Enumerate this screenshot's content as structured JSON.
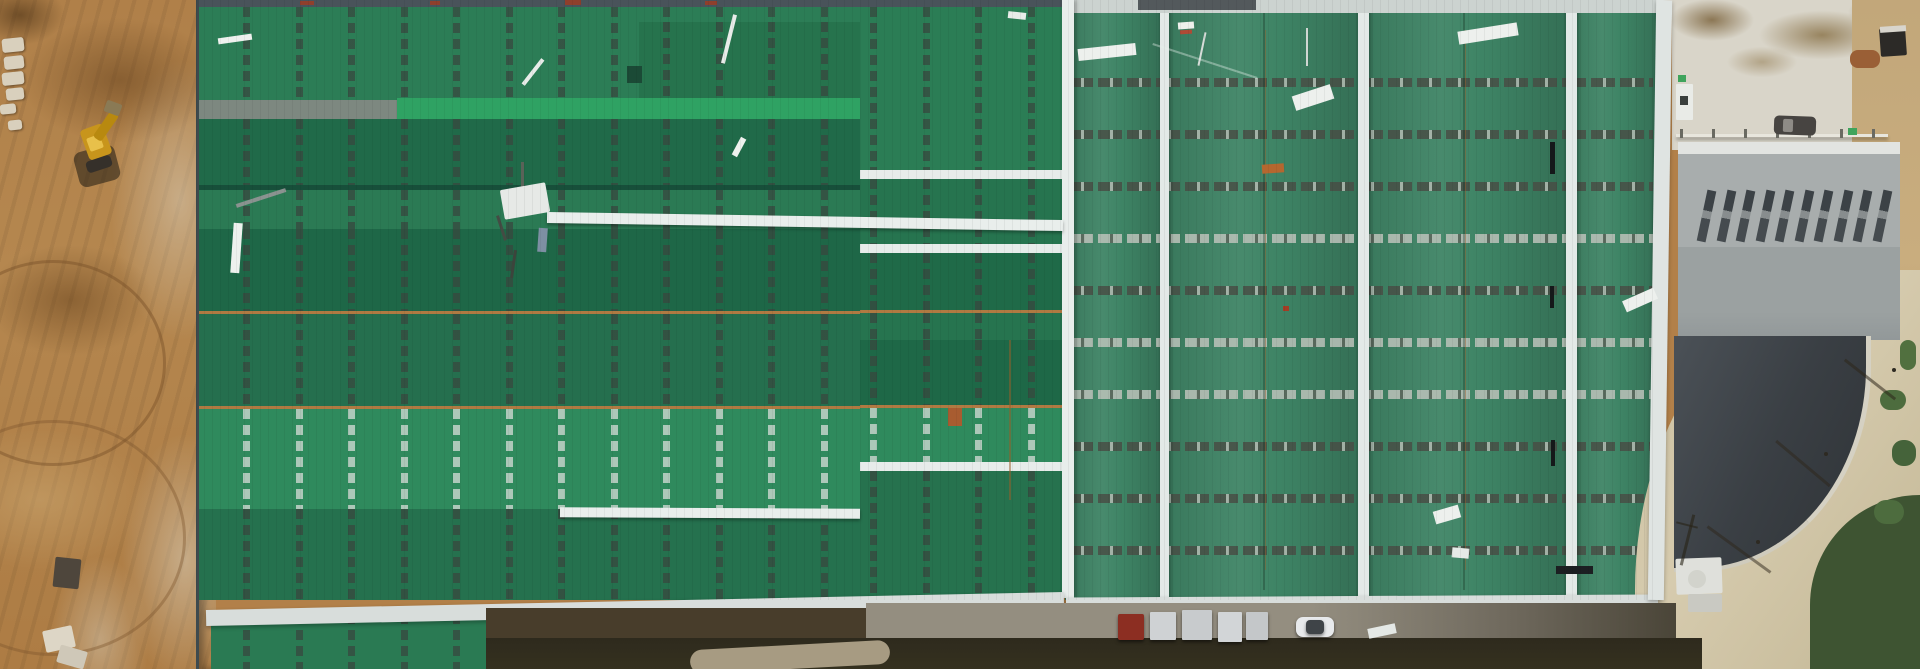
{
  "meta": {
    "title": "Aerial drone view of industrial warehouse construction site with green metal roofs, dirt earthworks, excavator, access road and parked vehicles",
    "width": 1920,
    "height": 669
  },
  "palette": {
    "green_dark": "#1e6747",
    "green_mid": "#2b7a54",
    "green_light": "#2f8a5d",
    "green_bright": "#2fa263",
    "green_textured": "#3e8465",
    "white_trim": "#e9eeec",
    "orange_ridge": "#b07a42",
    "dirt": "#b28049",
    "dirt_dark": "#8f6430",
    "dirt_light": "#cfa96f",
    "rubble": "#d8cdb9",
    "concrete": "#d9d5c9",
    "gray_roof": "#a8adad",
    "charcoal_roof": "#3a3f44",
    "road_tan": "#cfc3a3",
    "road_gray": "#8a8578",
    "vegetation": "#47603a",
    "excavator_yellow": "#d8a018"
  },
  "left_building": {
    "x": 196,
    "w": 664,
    "h": 669,
    "dash": {
      "spacing": 52.5,
      "offset": 44,
      "width": 7,
      "seg": 10,
      "gap": 6,
      "dark": "rgba(56,70,62,0.72)",
      "light": "rgba(208,218,211,0.78)"
    },
    "bands": [
      {
        "name": "roof-top-edge",
        "y": 0,
        "h": 7,
        "color": "#49535a"
      },
      {
        "name": "band-1",
        "y": 7,
        "h": 93,
        "color": "#2c7d56",
        "dash": "dark"
      },
      {
        "name": "band-1-inset",
        "y": 22,
        "h": 78,
        "x": 440,
        "w": 224,
        "color": "#26734d",
        "dash": "dark"
      },
      {
        "name": "ridge-cap-gray",
        "y": 100,
        "h": 20,
        "x": 0,
        "w": 198,
        "color": "#7d8880"
      },
      {
        "name": "bright-green-strip",
        "y": 98,
        "h": 21,
        "x": 198,
        "w": 466,
        "color": "#2fa263",
        "rib": true
      },
      {
        "name": "band-2",
        "y": 119,
        "h": 66,
        "color": "#206a49",
        "dash": "dark",
        "tex": true
      },
      {
        "name": "ridge-shadow-line",
        "y": 185,
        "h": 5,
        "color": "#174f3a"
      },
      {
        "name": "band-3",
        "y": 190,
        "h": 39,
        "color": "#2b7a54",
        "dash": "dark"
      },
      {
        "name": "band-4",
        "y": 229,
        "h": 82,
        "color": "#1e6747",
        "dash": "dark"
      },
      {
        "name": "orange-ridge-1",
        "y": 311,
        "h": 3,
        "color": "#b07a42"
      },
      {
        "name": "band-5",
        "y": 314,
        "h": 92,
        "color": "#256f4e",
        "dash": "dark",
        "tex": true
      },
      {
        "name": "orange-ridge-2",
        "y": 406,
        "h": 3,
        "color": "#b07a42"
      },
      {
        "name": "band-6",
        "y": 409,
        "h": 100,
        "color": "#2f8a5d",
        "dash": "light",
        "tex": true
      },
      {
        "name": "band-7",
        "y": 509,
        "h": 91,
        "color": "#25714e",
        "dash": "dark",
        "tex": true
      },
      {
        "name": "annex-roof",
        "y": 614,
        "h": 55,
        "x": 12,
        "w": 290,
        "color": "#2a7a53",
        "dash": "dark"
      }
    ]
  },
  "mid_section": {
    "x": 860,
    "w": 203,
    "h": 600,
    "dash": {
      "spacing": 52.5,
      "offset": 10,
      "width": 7,
      "dark": "rgba(56,70,62,0.72)",
      "light": "rgba(208,218,211,0.78)"
    },
    "bands": [
      {
        "name": "mid-top-edge",
        "y": 0,
        "h": 7,
        "color": "#49535a"
      },
      {
        "name": "mid-band-1",
        "y": 7,
        "h": 163,
        "color": "#2b7d55",
        "dash": "dark",
        "tex": true
      },
      {
        "name": "mid-divider",
        "y": 170,
        "h": 9,
        "color": "#e7ecea"
      },
      {
        "name": "mid-band-2",
        "y": 179,
        "h": 65,
        "color": "#26744f",
        "dash": "dark",
        "tex": true
      },
      {
        "name": "mid-divider",
        "y": 244,
        "h": 9,
        "color": "#e7ecea"
      },
      {
        "name": "mid-band-3",
        "y": 253,
        "h": 57,
        "color": "#1f6a48",
        "dash": "dark"
      },
      {
        "name": "mid-orange-1",
        "y": 310,
        "h": 3,
        "color": "#b07a42"
      },
      {
        "name": "mid-band-4",
        "y": 313,
        "h": 27,
        "color": "#26744f",
        "dash": "dark"
      },
      {
        "name": "mid-band-4b",
        "y": 340,
        "h": 65,
        "color": "#1e6847",
        "dash": "dark",
        "tex": true
      },
      {
        "name": "mid-orange-2",
        "y": 405,
        "h": 3,
        "color": "#b07a42"
      },
      {
        "name": "mid-band-5",
        "y": 408,
        "h": 54,
        "color": "#2f8a5d",
        "dash": "light",
        "tex": true
      },
      {
        "name": "mid-divider",
        "y": 462,
        "h": 9,
        "color": "#e7ecea"
      },
      {
        "name": "mid-band-6",
        "y": 471,
        "h": 129,
        "color": "#26724e",
        "dash": "dark",
        "tex": true
      }
    ]
  },
  "right_building": {
    "x": 1065,
    "w": 592,
    "h": 600,
    "base": "#3e8465",
    "top_strip": {
      "h": 13,
      "color": "#ccd3d0"
    },
    "rows": {
      "start": 78,
      "spacing": 52,
      "h": 9,
      "styles": [
        "dark",
        "dark",
        "dark",
        "silver",
        "dark",
        "silver",
        "silver",
        "dark",
        "dark",
        "dark"
      ],
      "dark": "repeating-linear-gradient(90deg, rgba(72,76,68,0.82) 0 12px, rgba(180,186,178,0.85) 12px 15px, rgba(72,76,68,0.82) 15px 24px, rgba(0,0,0,0) 24px 29px)",
      "silver": "repeating-linear-gradient(90deg, rgba(188,194,186,0.85) 0 12px, rgba(96,100,92,0.8) 12px 15px, rgba(188,194,186,0.85) 15px 24px, rgba(0,0,0,0) 24px 29px)"
    },
    "panels": [
      [
        0,
        95
      ],
      [
        95,
        293
      ],
      [
        293,
        501
      ],
      [
        501,
        592
      ]
    ],
    "inner_ridges": [
      {
        "x": 95,
        "w": 9
      },
      {
        "x": 293,
        "w": 11
      },
      {
        "x": 501,
        "w": 11
      }
    ],
    "valleys": [
      {
        "x": 198
      },
      {
        "x": 398
      }
    ]
  },
  "scene_ridges": [
    {
      "name": "roof-ridge-strip",
      "x": 1062,
      "y": 0,
      "w": 12,
      "h": 598,
      "color": "#e8edeb"
    }
  ],
  "stripes": [
    {
      "name": "white-walkway-stripe",
      "x": 547,
      "y": 216,
      "w": 516,
      "h": 11,
      "rot": 0.9,
      "color": "#e9eeec"
    },
    {
      "name": "white-walkway-stripe",
      "x": 560,
      "y": 508,
      "w": 300,
      "h": 10,
      "rot": 0.3,
      "color": "#e9eeec"
    }
  ],
  "eaves": [
    {
      "name": "eave-strip-left",
      "x": 206,
      "y": 601,
      "w": 858,
      "h": 16,
      "rot": -1.2,
      "color": "#d8dddb"
    },
    {
      "name": "eave-strip-right",
      "x": 1066,
      "y": 596,
      "w": 592,
      "h": 13,
      "rot": -0.3,
      "color": "#d8dddb"
    },
    {
      "name": "eave-strip-east",
      "x": 1652,
      "y": 0,
      "w": 16,
      "h": 600,
      "rot": 0.8,
      "color": "#dfe4e2"
    }
  ],
  "bottom": {
    "vehicles": [
      {
        "name": "red-box-truck",
        "x": 1118,
        "y": 614,
        "w": 26,
        "h": 26,
        "color": "#8c2e22",
        "r": 2
      },
      {
        "name": "material-stack",
        "x": 1150,
        "y": 612,
        "w": 26,
        "h": 28,
        "color": "#cfd2d4",
        "r": 1
      },
      {
        "name": "material-stack",
        "x": 1182,
        "y": 610,
        "w": 30,
        "h": 30,
        "color": "#c8cbcd",
        "r": 1
      },
      {
        "name": "material-stack",
        "x": 1218,
        "y": 612,
        "w": 24,
        "h": 30,
        "color": "#d2d5d7",
        "r": 1
      },
      {
        "name": "material-stack",
        "x": 1246,
        "y": 612,
        "w": 22,
        "h": 28,
        "color": "#c4c7c9",
        "r": 1
      },
      {
        "name": "white-car",
        "x": 1296,
        "y": 617,
        "w": 38,
        "h": 20,
        "color": "#e8eaec",
        "r": 7
      },
      {
        "name": "white-car-roof",
        "x": 1306,
        "y": 620,
        "w": 18,
        "h": 14,
        "color": "#3f4448",
        "r": 4
      }
    ]
  },
  "far_right": {
    "windows": {
      "count": 10,
      "x0": 1702,
      "step": 19.5,
      "y": 190,
      "w": 9,
      "h": 52,
      "rot": 12,
      "bg": "linear-gradient(180deg,#3c4246 0 40%, rgba(60,66,70,0.3) 40% 55%, #454b4f 55%)"
    },
    "fence_posts": {
      "count": 7,
      "x0": 1680,
      "step": 32,
      "y": 129,
      "w": 3,
      "h": 9,
      "color": "#6a6a62"
    }
  },
  "objects": [
    {
      "name": "red-edge-mark",
      "x": 300,
      "y": 1,
      "w": 14,
      "h": 4,
      "color": "#8f3f2c"
    },
    {
      "name": "red-edge-mark",
      "x": 430,
      "y": 1,
      "w": 10,
      "h": 4,
      "color": "#8f3f2c"
    },
    {
      "name": "red-edge-mark",
      "x": 565,
      "y": 0,
      "w": 16,
      "h": 5,
      "color": "#8f3f2c"
    },
    {
      "name": "red-edge-mark",
      "x": 705,
      "y": 1,
      "w": 12,
      "h": 4,
      "color": "#8f3f2c"
    },
    {
      "name": "roof-frame-piece",
      "x": 1138,
      "y": 0,
      "w": 118,
      "h": 10,
      "color": "#53595c"
    },
    {
      "name": "white-plank",
      "x": 218,
      "y": 36,
      "w": 34,
      "h": 6,
      "color": "#eef1ee",
      "rot": -8
    },
    {
      "name": "white-plank",
      "x": 727,
      "y": 14,
      "w": 4,
      "h": 50,
      "color": "#e8ece9",
      "rot": 14
    },
    {
      "name": "white-plank",
      "x": 531,
      "y": 56,
      "w": 4,
      "h": 32,
      "color": "#e8ece9",
      "rot": 38
    },
    {
      "name": "white-plank",
      "x": 232,
      "y": 223,
      "w": 9,
      "h": 50,
      "color": "#eef1ee",
      "rot": 4
    },
    {
      "name": "white-plank",
      "x": 736,
      "y": 137,
      "w": 6,
      "h": 20,
      "color": "#eef1ee",
      "rot": 28
    },
    {
      "name": "debris-stick",
      "x": 235,
      "y": 196,
      "w": 52,
      "h": 4,
      "color": "#8a9390",
      "rot": -18
    },
    {
      "name": "dark-panel-patch",
      "x": 627,
      "y": 66,
      "w": 15,
      "h": 17,
      "color": "#1b4a36"
    },
    {
      "name": "white-plank",
      "x": 1078,
      "y": 46,
      "w": 58,
      "h": 12,
      "color": "#edf0ed",
      "rot": -6
    },
    {
      "name": "white-plank",
      "x": 1293,
      "y": 90,
      "w": 40,
      "h": 15,
      "color": "#edf0ed",
      "rot": -18
    },
    {
      "name": "white-plank",
      "x": 1458,
      "y": 27,
      "w": 60,
      "h": 13,
      "color": "#edf0ed",
      "rot": -9
    },
    {
      "name": "white-plank",
      "x": 1623,
      "y": 294,
      "w": 34,
      "h": 12,
      "color": "#edf0ed",
      "rot": -24
    },
    {
      "name": "white-plank",
      "x": 1368,
      "y": 626,
      "w": 28,
      "h": 10,
      "color": "#e4e8e5",
      "rot": -12
    },
    {
      "name": "white-plank",
      "x": 1008,
      "y": 12,
      "w": 18,
      "h": 7,
      "color": "#e8ece9",
      "rot": 6
    },
    {
      "name": "white-plank",
      "x": 1434,
      "y": 508,
      "w": 26,
      "h": 13,
      "color": "#edf0ed",
      "rot": -16
    },
    {
      "name": "white-plank",
      "x": 1452,
      "y": 548,
      "w": 17,
      "h": 10,
      "color": "#e6eae7",
      "rot": 5
    },
    {
      "name": "white-label-tag",
      "x": 1178,
      "y": 22,
      "w": 16,
      "h": 7,
      "color": "#eef0ec",
      "rot": -4
    },
    {
      "name": "red-label-mark",
      "x": 1180,
      "y": 30,
      "w": 12,
      "h": 4,
      "color": "#b04a35",
      "rot": -4
    },
    {
      "name": "thin-pole",
      "x": 1306,
      "y": 28,
      "w": 2,
      "h": 38,
      "color": "#cfd6d2"
    },
    {
      "name": "thin-pole",
      "x": 1201,
      "y": 32,
      "w": 2,
      "h": 34,
      "color": "#d6dcd8",
      "rot": 12
    },
    {
      "name": "scratch-line",
      "x": 1150,
      "y": 60,
      "w": 110,
      "h": 2,
      "color": "rgba(230,240,235,0.4)",
      "rot": 18
    },
    {
      "name": "equipment-mast",
      "x": 521,
      "y": 162,
      "w": 3,
      "h": 30,
      "color": "#5a6258"
    },
    {
      "name": "equipment-box",
      "x": 502,
      "y": 186,
      "w": 46,
      "h": 30,
      "color": "#e6e9e6",
      "rot": -10,
      "r": 2
    },
    {
      "name": "equipment-leg",
      "x": 500,
      "y": 215,
      "w": 3,
      "h": 26,
      "color": "#444c44",
      "rot": -18
    },
    {
      "name": "equipment-leg",
      "x": 512,
      "y": 250,
      "w": 3,
      "h": 28,
      "color": "#3c443c",
      "rot": 8
    },
    {
      "name": "equipment-tag",
      "x": 538,
      "y": 228,
      "w": 9,
      "h": 24,
      "color": "#7d8fa3",
      "rot": 4
    },
    {
      "name": "rust-patch",
      "x": 948,
      "y": 408,
      "w": 14,
      "h": 18,
      "color": "#a85c30"
    },
    {
      "name": "rust-patch",
      "x": 1262,
      "y": 164,
      "w": 22,
      "h": 9,
      "color": "#b5672f",
      "rot": -4
    },
    {
      "name": "rust-dot",
      "x": 1283,
      "y": 306,
      "w": 6,
      "h": 5,
      "color": "#a33d25"
    },
    {
      "name": "roof-gap-mark",
      "x": 1550,
      "y": 142,
      "w": 5,
      "h": 32,
      "color": "#15181a"
    },
    {
      "name": "roof-gap-mark",
      "x": 1550,
      "y": 286,
      "w": 4,
      "h": 22,
      "color": "#15181a"
    },
    {
      "name": "roof-gap-mark",
      "x": 1551,
      "y": 440,
      "w": 4,
      "h": 26,
      "color": "#15181a"
    },
    {
      "name": "roof-corner-shadow",
      "x": 1556,
      "y": 566,
      "w": 37,
      "h": 8,
      "color": "#1c1f22"
    },
    {
      "name": "excavator-shadow",
      "x": 76,
      "y": 148,
      "w": 42,
      "h": 36,
      "color": "rgba(30,25,18,0.55)",
      "r": 8,
      "rot": -15
    },
    {
      "name": "excavator-body",
      "x": 84,
      "y": 126,
      "w": 24,
      "h": 32,
      "color": "#c8951c",
      "rot": -20,
      "r": 4
    },
    {
      "name": "excavator-cab",
      "x": 88,
      "y": 136,
      "w": 14,
      "h": 14,
      "color": "#e8c04a",
      "rot": -20,
      "r": 2
    },
    {
      "name": "excavator-arm",
      "x": 101,
      "y": 110,
      "w": 10,
      "h": 32,
      "color": "#b8890f",
      "rot": 35,
      "r": 3
    },
    {
      "name": "excavator-bucket",
      "x": 105,
      "y": 102,
      "w": 16,
      "h": 12,
      "color": "#8a7a55",
      "rot": 20,
      "r": 2
    },
    {
      "name": "excavator-wheels",
      "x": 86,
      "y": 158,
      "w": 26,
      "h": 12,
      "color": "#35302a",
      "rot": -18,
      "r": 4
    },
    {
      "name": "debris-white-block",
      "x": 44,
      "y": 628,
      "w": 30,
      "h": 22,
      "color": "#ddd6c6",
      "rot": -12,
      "r": 2
    },
    {
      "name": "debris-white-block",
      "x": 58,
      "y": 648,
      "w": 28,
      "h": 18,
      "color": "#cfc8b8",
      "rot": 16,
      "r": 2
    },
    {
      "name": "debris-dark-block",
      "x": 54,
      "y": 558,
      "w": 26,
      "h": 30,
      "color": "#4e463c",
      "rot": 6,
      "r": 2
    },
    {
      "name": "ground-road-curve",
      "x": 690,
      "y": 645,
      "w": 200,
      "h": 24,
      "color": "#a79b82",
      "rot": -3,
      "r": 12
    },
    {
      "name": "suv-car",
      "x": 1774,
      "y": 116,
      "w": 42,
      "h": 19,
      "color": "#474441",
      "rot": 2,
      "r": 5
    },
    {
      "name": "suv-windshield",
      "x": 1783,
      "y": 119,
      "w": 10,
      "h": 13,
      "color": "#8e8b86",
      "rot": 2,
      "r": 2
    },
    {
      "name": "trailer-dark",
      "x": 1880,
      "y": 28,
      "w": 26,
      "h": 28,
      "color": "#2c2a27",
      "rot": -4,
      "r": 2
    },
    {
      "name": "trailer-top",
      "x": 1880,
      "y": 26,
      "w": 26,
      "h": 6,
      "color": "#d8d5cd",
      "rot": -4
    },
    {
      "name": "mulch-pile",
      "x": 1850,
      "y": 50,
      "w": 30,
      "h": 18,
      "color": "#9a5f36",
      "r": 8
    },
    {
      "name": "pad-structure",
      "x": 1676,
      "y": 84,
      "w": 17,
      "h": 36,
      "color": "#e9ebe7",
      "r": 1
    },
    {
      "name": "pad-structure-door",
      "x": 1680,
      "y": 96,
      "w": 8,
      "h": 9,
      "color": "#3a3f3d"
    },
    {
      "name": "pad-green-marker",
      "x": 1678,
      "y": 75,
      "w": 8,
      "h": 7,
      "color": "#3fa45c"
    },
    {
      "name": "pad-green-marker",
      "x": 1848,
      "y": 128,
      "w": 9,
      "h": 7,
      "color": "#3fa45c"
    },
    {
      "name": "rooftop-tank",
      "x": 1688,
      "y": 570,
      "w": 18,
      "h": 18,
      "color": "#d2d3cc",
      "r": 9
    },
    {
      "name": "loading-dock",
      "x": 1688,
      "y": 594,
      "w": 34,
      "h": 18,
      "color": "#c9c9c2",
      "r": 2
    },
    {
      "name": "bush",
      "x": 1880,
      "y": 390,
      "w": 26,
      "h": 20,
      "color": "#4d6c3e",
      "r": 10
    },
    {
      "name": "bush",
      "x": 1892,
      "y": 440,
      "w": 24,
      "h": 26,
      "color": "#45633a",
      "r": 11
    },
    {
      "name": "bush",
      "x": 1874,
      "y": 500,
      "w": 30,
      "h": 24,
      "color": "#4d6c3e",
      "r": 12
    },
    {
      "name": "bush",
      "x": 1900,
      "y": 340,
      "w": 16,
      "h": 30,
      "color": "#51703f",
      "r": 8
    },
    {
      "name": "pole-shadow",
      "x": 1838,
      "y": 378,
      "w": 64,
      "h": 3,
      "color": "rgba(45,38,25,0.55)",
      "rot": 38
    },
    {
      "name": "pole-shadow",
      "x": 1768,
      "y": 462,
      "w": 70,
      "h": 3,
      "color": "rgba(45,38,25,0.5)",
      "rot": 40
    },
    {
      "name": "pole-shadow",
      "x": 1700,
      "y": 548,
      "w": 78,
      "h": 3,
      "color": "rgba(45,38,25,0.5)",
      "rot": 36
    },
    {
      "name": "power-pole",
      "x": 1892,
      "y": 368,
      "w": 4,
      "h": 4,
      "color": "#2e2a22",
      "r": 2
    },
    {
      "name": "power-pole",
      "x": 1824,
      "y": 452,
      "w": 4,
      "h": 4,
      "color": "#2e2a22",
      "r": 2
    },
    {
      "name": "power-pole",
      "x": 1756,
      "y": 540,
      "w": 4,
      "h": 4,
      "color": "#2e2a22",
      "r": 2
    },
    {
      "name": "power-pole-shadow",
      "x": 1686,
      "y": 514,
      "w": 3,
      "h": 52,
      "color": "rgba(40,35,22,0.6)",
      "rot": 14
    },
    {
      "name": "power-pole-crossarm",
      "x": 1676,
      "y": 524,
      "w": 22,
      "h": 2,
      "color": "rgba(40,35,22,0.6)",
      "rot": 14
    }
  ],
  "dirt": {
    "stones": [
      {
        "x": 2,
        "y": 38,
        "w": 22,
        "h": 14
      },
      {
        "x": 4,
        "y": 56,
        "w": 20,
        "h": 13
      },
      {
        "x": 2,
        "y": 72,
        "w": 22,
        "h": 13
      },
      {
        "x": 6,
        "y": 88,
        "w": 18,
        "h": 12
      },
      {
        "x": 0,
        "y": 104,
        "w": 16,
        "h": 10
      },
      {
        "x": 8,
        "y": 120,
        "w": 14,
        "h": 10
      }
    ],
    "stone_color": "#d9d0bd"
  }
}
